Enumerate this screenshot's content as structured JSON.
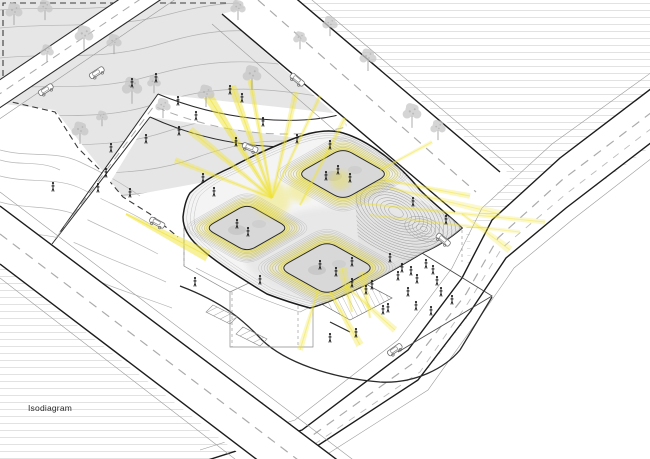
{
  "diagram": {
    "label": "Isodiagram",
    "type": "isometric architectural site diagram",
    "description": "Axonometric site diagram of a building with three sunken courtyards emitting yellow light, surrounded by roads, trees, cars and pedestrians"
  },
  "palette": {
    "background": "#ffffff",
    "ruling": "#e2e2e2",
    "site_fill": "#e6e6e6",
    "contour": "#b2b2b2",
    "ink": "#1c1c1c",
    "mid_line": "#555555",
    "light_line": "#999999",
    "road_dash": "#ababab",
    "accent_yellow": "#f0e335",
    "glow_yellow": "#f7ef7d",
    "tree_gray": "#c7c7c7",
    "figure_black": "#141414",
    "courtyard_floor": "#d8d8d8",
    "ring_gray": "#9a9a9a"
  },
  "scene": {
    "roads": [
      "site-street-upper",
      "service-street",
      "main-road",
      "avenue-road",
      "bottom-road"
    ],
    "courtyards": [
      {
        "name": "west",
        "cx": 247,
        "cy": 228,
        "rx": 42,
        "ry": 24
      },
      {
        "name": "northeast",
        "cx": 343,
        "cy": 174,
        "rx": 46,
        "ry": 26
      },
      {
        "name": "south",
        "cx": 327,
        "cy": 268,
        "rx": 48,
        "ry": 27
      }
    ],
    "people_site": [
      [
        156,
        78
      ],
      [
        132,
        83
      ],
      [
        178,
        101
      ],
      [
        230,
        90
      ],
      [
        179,
        131
      ],
      [
        146,
        139
      ],
      [
        111,
        148
      ],
      [
        196,
        116
      ],
      [
        53,
        187
      ],
      [
        106,
        173
      ],
      [
        130,
        193
      ],
      [
        236,
        142
      ],
      [
        98,
        188
      ],
      [
        263,
        122
      ],
      [
        242,
        98
      ]
    ],
    "people_roof": [
      [
        330,
        145
      ],
      [
        297,
        139
      ],
      [
        413,
        202
      ],
      [
        446,
        220
      ],
      [
        203,
        178
      ],
      [
        214,
        192
      ]
    ],
    "people_courtyards": [
      [
        338,
        170
      ],
      [
        350,
        178
      ],
      [
        326,
        176
      ],
      [
        237,
        224
      ],
      [
        248,
        232
      ],
      [
        320,
        265
      ],
      [
        336,
        272
      ],
      [
        352,
        262
      ]
    ],
    "people_plaza": [
      [
        390,
        258
      ],
      [
        402,
        268
      ],
      [
        411,
        271
      ],
      [
        398,
        276
      ],
      [
        417,
        279
      ],
      [
        437,
        281
      ],
      [
        408,
        292
      ],
      [
        388,
        308
      ],
      [
        416,
        306
      ],
      [
        426,
        264
      ],
      [
        433,
        270
      ],
      [
        441,
        292
      ],
      [
        452,
        300
      ],
      [
        431,
        311
      ],
      [
        352,
        283
      ],
      [
        372,
        285
      ],
      [
        383,
        310
      ],
      [
        330,
        338
      ],
      [
        260,
        280
      ],
      [
        195,
        282
      ],
      [
        356,
        333
      ],
      [
        366,
        290
      ]
    ],
    "trees": [
      [
        14,
        16,
        1
      ],
      [
        45,
        12,
        0.9
      ],
      [
        84,
        40,
        1.1
      ],
      [
        47,
        55,
        0.8
      ],
      [
        114,
        46,
        0.9
      ],
      [
        132,
        93,
        1.2
      ],
      [
        80,
        135,
        1
      ],
      [
        154,
        86,
        0.8
      ],
      [
        163,
        110,
        0.9
      ],
      [
        102,
        120,
        0.7
      ],
      [
        206,
        98,
        1
      ],
      [
        238,
        12,
        0.9
      ],
      [
        252,
        80,
        1.1
      ],
      [
        300,
        42,
        0.8
      ],
      [
        330,
        28,
        0.9
      ],
      [
        368,
        62,
        1
      ],
      [
        412,
        118,
        1.1
      ],
      [
        438,
        132,
        0.9
      ]
    ],
    "cars": [
      [
        46,
        90,
        -33
      ],
      [
        97,
        73,
        -33
      ],
      [
        297,
        80,
        40
      ],
      [
        250,
        148,
        22
      ],
      [
        157,
        223,
        28
      ],
      [
        395,
        350,
        -35
      ],
      [
        443,
        240,
        40
      ]
    ],
    "light_rays": [
      [
        272,
        198,
        208,
        96,
        10,
        0.5
      ],
      [
        272,
        198,
        232,
        86,
        8,
        0.45
      ],
      [
        272,
        198,
        250,
        80,
        5,
        0.4
      ],
      [
        272,
        198,
        190,
        130,
        8,
        0.4
      ],
      [
        272,
        198,
        296,
        92,
        6,
        0.35
      ],
      [
        272,
        198,
        320,
        96,
        4,
        0.3
      ],
      [
        272,
        198,
        175,
        160,
        6,
        0.35
      ],
      [
        300,
        205,
        345,
        118,
        5,
        0.3
      ],
      [
        385,
        180,
        470,
        196,
        6,
        0.3
      ],
      [
        390,
        188,
        500,
        214,
        8,
        0.25
      ],
      [
        380,
        170,
        432,
        142,
        4,
        0.25
      ],
      [
        330,
        292,
        360,
        345,
        8,
        0.35
      ],
      [
        318,
        290,
        300,
        350,
        6,
        0.3
      ],
      [
        345,
        285,
        395,
        330,
        7,
        0.3
      ],
      [
        352,
        312,
        342,
        268,
        10,
        0.3
      ],
      [
        370,
        318,
        362,
        272,
        9,
        0.28
      ],
      [
        126,
        214,
        208,
        256,
        12,
        0.5
      ],
      [
        358,
        203,
        545,
        222,
        5,
        0.25
      ],
      [
        370,
        215,
        520,
        232,
        4,
        0.2
      ],
      [
        462,
        214,
        510,
        250,
        8,
        0.25
      ]
    ],
    "glow_spots": [
      [
        272,
        200,
        18
      ],
      [
        300,
        190,
        12
      ],
      [
        340,
        180,
        10
      ]
    ]
  }
}
